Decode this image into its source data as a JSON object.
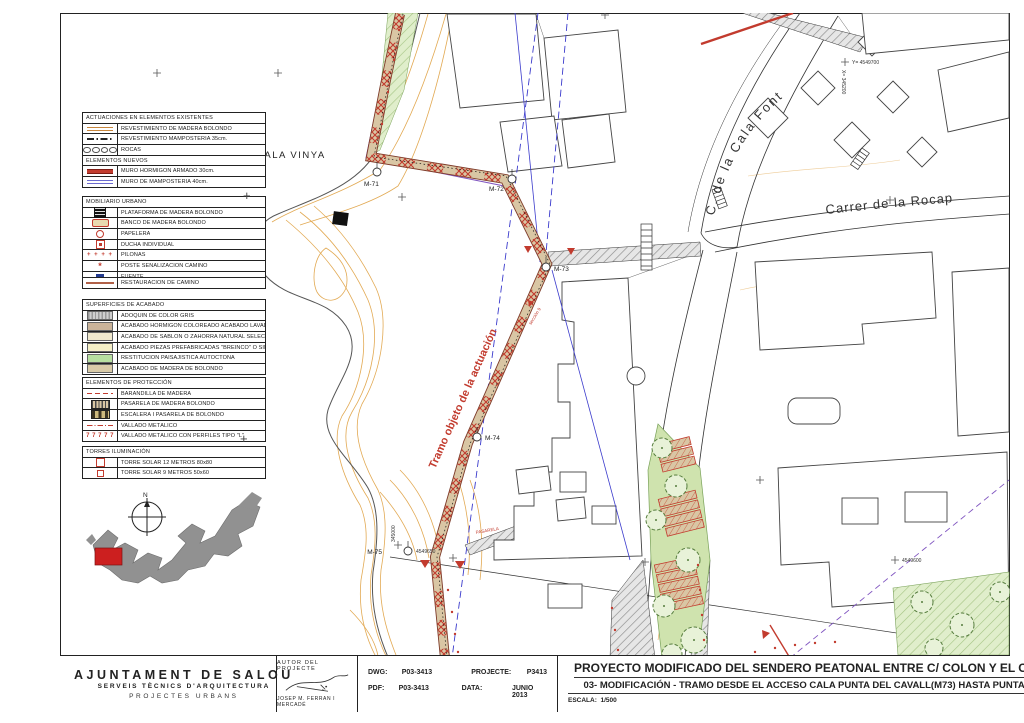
{
  "legend": {
    "glyphs": {
      "cross": "+",
      "pilonas": "+  +  +  +",
      "poste": "*",
      "vallado_l": "7 7 7 7 7"
    },
    "existing": {
      "title": "ACTUACIONES EN ELEMENTOS EXISTENTES",
      "rows": [
        "REVESTIMIENTO DE MADERA BOLONDO",
        "REVESTIMIENTO MAMPOSTERÍA 35cm.",
        "ROCAS"
      ],
      "new_title": "ELEMENTOS NUEVOS",
      "new_rows": [
        "MURO HORMIGÓN ARMADO 30cm.",
        "MURO DE MAMPOSTERÍA 40cm."
      ]
    },
    "mobiliario": {
      "title": "MOBILIARIO URBANO",
      "rows": [
        "PLATAFORMA DE MADERA BOLONDO",
        "BANCO DE MADERA BOLONDO",
        "PAPELERA",
        "DUCHA INDIVIDUAL",
        "PILONAS",
        "POSTE SEÑALIZACIÓN CAMINO",
        "FUENTE"
      ]
    },
    "restauracion": "RESTAURACIÓN DE CAMINO",
    "superficies": {
      "title": "SUPERFICIES DE ACABADO",
      "rows": [
        "ADOQUÍN DE COLOR GRIS",
        "ACABADO HORMIGÓN COLOREADO ACABADO LAVADO AL ÁCIDO",
        "ACABADO DE SABLÓN O ZAHORRA NATURAL SELECCIONADA",
        "ACABADO PIEZAS PREFABRICADAS \"BREINCO\" O SIMILAR",
        "RESTITUCIÓN PAISAJÍSTICA AUTÓCTONA",
        "ACABADO DE MADERA DE BOLONDO"
      ]
    },
    "proteccion": {
      "title": "ELEMENTOS DE PROTECCIÓN",
      "rows": [
        "BARANDILLA DE MADERA",
        "PASARELA DE MADERA BOLONDO",
        "ESCALERA I PASARELA DE BOLONDO",
        "VALLADO METÁLICO",
        "VALLADO METÁLICO CON PERFILES TIPO \"L\""
      ]
    },
    "torres": {
      "title": "TORRES ILUMINACIÓN",
      "rows": [
        "TORRE SOLAR 12 METROS 80x80",
        "TORRE SOLAR 9 METROS 50x60"
      ]
    }
  },
  "map": {
    "cove_label": "CALA VINYA",
    "street_cala_font": "C.  de  la  Cala  Font",
    "street_rocaplana": "Carrer de la Rocap",
    "tramo_label": "Tramo objeto de la actuación",
    "pasarela_label": "PASARELA",
    "seccion_label": "sección 9",
    "north_label": "N",
    "markers": {
      "m71": "M-71",
      "m72": "M-72",
      "m73": "M-73",
      "m74": "M-74",
      "m75": "M-75"
    },
    "coords": {
      "y_top": "Y= 4549700",
      "x_top": "X= 345200",
      "x_left": "345000",
      "y_left": "4549650",
      "y_right": "4549600"
    }
  },
  "titleblock": {
    "org": "AJUNTAMENT DE SALOU",
    "dept": "SERVEIS TÈCNICS D'ARQUITECTURA",
    "unit": "PROJECTES URBANS",
    "author_title": "AUTOR DEL PROJECTE",
    "author_name": "JOSEP M. FERRAN I MERCADÉ",
    "dwg_label": "DWG:",
    "dwg": "P03-3413",
    "pdf_label": "PDF:",
    "pdf": "P03-3413",
    "projecte_label": "PROJECTE:",
    "projecte": "P3413",
    "data_label": "DATA:",
    "data": "JUNIO 2013",
    "title": "PROYECTO MODIFICADO DEL SENDERO PEATONAL ENTRE C/ COLON Y EL CABO DE SALOU.",
    "subtitle": "03- MODIFICACIÓN - TRAMO DESDE EL ACCESO CALA PUNTA DEL CAVALL(M73) HASTA PUNTA DEL CAVALL (M75)",
    "escala_label": "ESCALA:",
    "escala": "1/500",
    "planol_label": "PLÀNOL:",
    "planol": "03"
  },
  "colors": {
    "action_red": "#c23b2e",
    "contour_orange": "#dfa040",
    "green_area": "#cfe3ae",
    "utility_blue": "#3b3bcc",
    "utility_purple": "#8055c0",
    "path_sand": "#d9c6a4"
  }
}
